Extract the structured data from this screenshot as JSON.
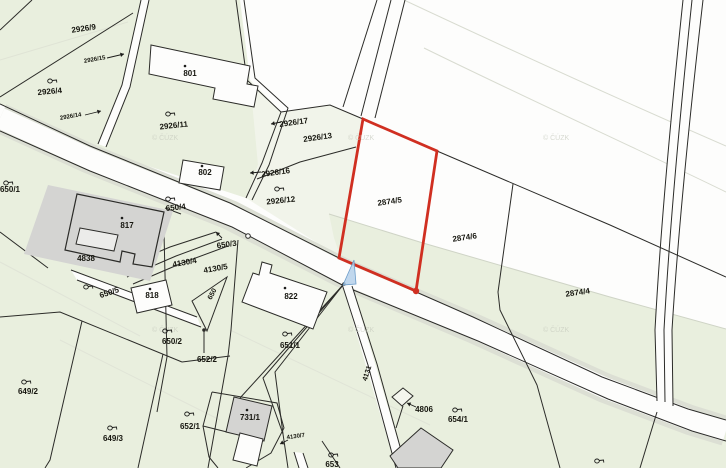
{
  "map": {
    "type": "cadastral-parcel-map",
    "watermark": "© ČÚZK",
    "selected_parcel": "2874/5",
    "colors": {
      "parcel_green": "#e9efde",
      "pale_green": "#f1f4ea",
      "white_area": "#fdfdfc",
      "boundary_black": "#2b2b28",
      "highlight_red": "#d02f21",
      "marker_blue": "#b5d0ea",
      "building_gray": "#d4d4d2",
      "contour_gray": "#d8dbd0"
    },
    "labels": [
      {
        "t": "2926/9",
        "x": 84,
        "y": 31,
        "r": -8
      },
      {
        "t": "2926/15",
        "x": 95,
        "y": 61,
        "r": -10,
        "s": 6,
        "arr": [
          107,
          58,
          124,
          54
        ]
      },
      {
        "t": "2926/4",
        "x": 50,
        "y": 94,
        "r": -5,
        "sym": [
          50,
          81
        ]
      },
      {
        "t": "2926/14",
        "x": 71,
        "y": 118,
        "r": -10,
        "s": 6,
        "arr": [
          85,
          115,
          101,
          111
        ]
      },
      {
        "t": "801",
        "x": 190,
        "y": 76,
        "dot": [
          185,
          66
        ]
      },
      {
        "t": "2926/11",
        "x": 174,
        "y": 128,
        "r": -6,
        "sym": [
          168,
          114
        ]
      },
      {
        "t": "2926/17",
        "x": 294,
        "y": 125,
        "r": -8,
        "arr": [
          281,
          122,
          271,
          124
        ]
      },
      {
        "t": "2926/13",
        "x": 318,
        "y": 140,
        "r": -8
      },
      {
        "t": "2926/16",
        "x": 276,
        "y": 175,
        "r": -8,
        "arr": [
          261,
          172,
          250,
          173
        ]
      },
      {
        "t": "802",
        "x": 205,
        "y": 175,
        "dot": [
          202,
          166
        ]
      },
      {
        "t": "2926/12",
        "x": 281,
        "y": 203,
        "r": -6,
        "sym": [
          277,
          189
        ]
      },
      {
        "t": "650/1",
        "x": 10,
        "y": 192,
        "sym": [
          6,
          183
        ]
      },
      {
        "t": "650/4",
        "x": 176,
        "y": 210,
        "r": -6,
        "sym": [
          168,
          199
        ]
      },
      {
        "t": "817",
        "x": 127,
        "y": 228,
        "dot": [
          122,
          218
        ]
      },
      {
        "t": "4838",
        "x": 86,
        "y": 261
      },
      {
        "t": "650/3",
        "x": 227,
        "y": 247,
        "r": -8,
        "arr": [
          222,
          238,
          216,
          232
        ]
      },
      {
        "t": "4130/4",
        "x": 185,
        "y": 265,
        "r": -10
      },
      {
        "t": "4130/5",
        "x": 216,
        "y": 271,
        "r": -10
      },
      {
        "t": "650/5",
        "x": 110,
        "y": 295,
        "r": -18,
        "sym": [
          86,
          287
        ]
      },
      {
        "t": "818",
        "x": 152,
        "y": 298,
        "dot": [
          150,
          289
        ]
      },
      {
        "t": "650",
        "x": 214,
        "y": 295,
        "r": -62,
        "s": 7
      },
      {
        "t": "822",
        "x": 291,
        "y": 299,
        "dot": [
          285,
          288
        ]
      },
      {
        "t": "2874/5",
        "x": 390,
        "y": 204,
        "r": -8
      },
      {
        "t": "2874/6",
        "x": 465,
        "y": 240,
        "r": -8
      },
      {
        "t": "2874/4",
        "x": 578,
        "y": 295,
        "r": -8
      },
      {
        "t": "651/1",
        "x": 290,
        "y": 348,
        "sym": [
          285,
          334
        ]
      },
      {
        "t": "650/2",
        "x": 172,
        "y": 344,
        "sym": [
          165,
          331
        ]
      },
      {
        "t": "652/2",
        "x": 207,
        "y": 362
      },
      {
        "t": "649/2",
        "x": 28,
        "y": 394,
        "sym": [
          24,
          382
        ]
      },
      {
        "t": "4131",
        "x": 369,
        "y": 374,
        "r": -72,
        "s": 7
      },
      {
        "t": "4806",
        "x": 424,
        "y": 412,
        "arr": [
          416,
          407,
          407,
          403
        ]
      },
      {
        "t": "654/1",
        "x": 458,
        "y": 422,
        "sym": [
          455,
          410
        ]
      },
      {
        "t": "652/1",
        "x": 190,
        "y": 429,
        "sym": [
          187,
          414
        ]
      },
      {
        "t": "731/1",
        "x": 250,
        "y": 420,
        "dot": [
          247,
          410
        ]
      },
      {
        "t": "649/3",
        "x": 113,
        "y": 441,
        "sym": [
          110,
          428
        ]
      },
      {
        "t": "4130/7",
        "x": 296,
        "y": 438,
        "r": -8,
        "s": 6,
        "arr": [
          288,
          440,
          280,
          444
        ]
      },
      {
        "t": "653",
        "x": 332,
        "y": 467,
        "sym": [
          331,
          455
        ]
      }
    ],
    "extra_symbols": [
      [
        597,
        461
      ]
    ]
  }
}
